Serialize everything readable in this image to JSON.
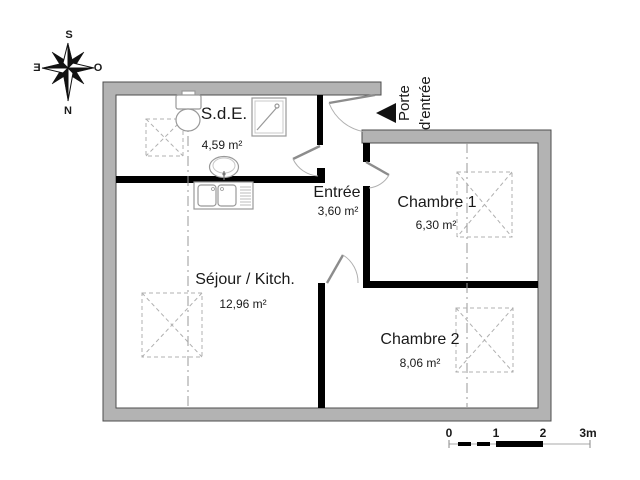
{
  "floor_plan": {
    "rooms": [
      {
        "name": "S.d.E.",
        "area": "4,59 m²"
      },
      {
        "name": "Entrée",
        "area": "3,60 m²"
      },
      {
        "name": "Chambre 1",
        "area": "6,30 m²"
      },
      {
        "name": "Séjour / Kitch.",
        "area": "12,96 m²"
      },
      {
        "name": "Chambre 2",
        "area": "8,06 m²"
      }
    ],
    "entry_door": {
      "line1": "Porte",
      "line2": "d'entrée"
    },
    "compass": {
      "top": "S",
      "bottom": "N",
      "left": "E",
      "right": "O"
    },
    "scale_bar": {
      "tick0": "0",
      "tick1": "1",
      "tick2": "2",
      "tick3": "3m"
    },
    "colors": {
      "outer_wall": "#b3b3b3",
      "outer_wall_outline": "#4d4d4d",
      "partition_wall": "#000000",
      "dashed_symbols": "#b0b0b0",
      "text": "#1a1a1a"
    }
  }
}
